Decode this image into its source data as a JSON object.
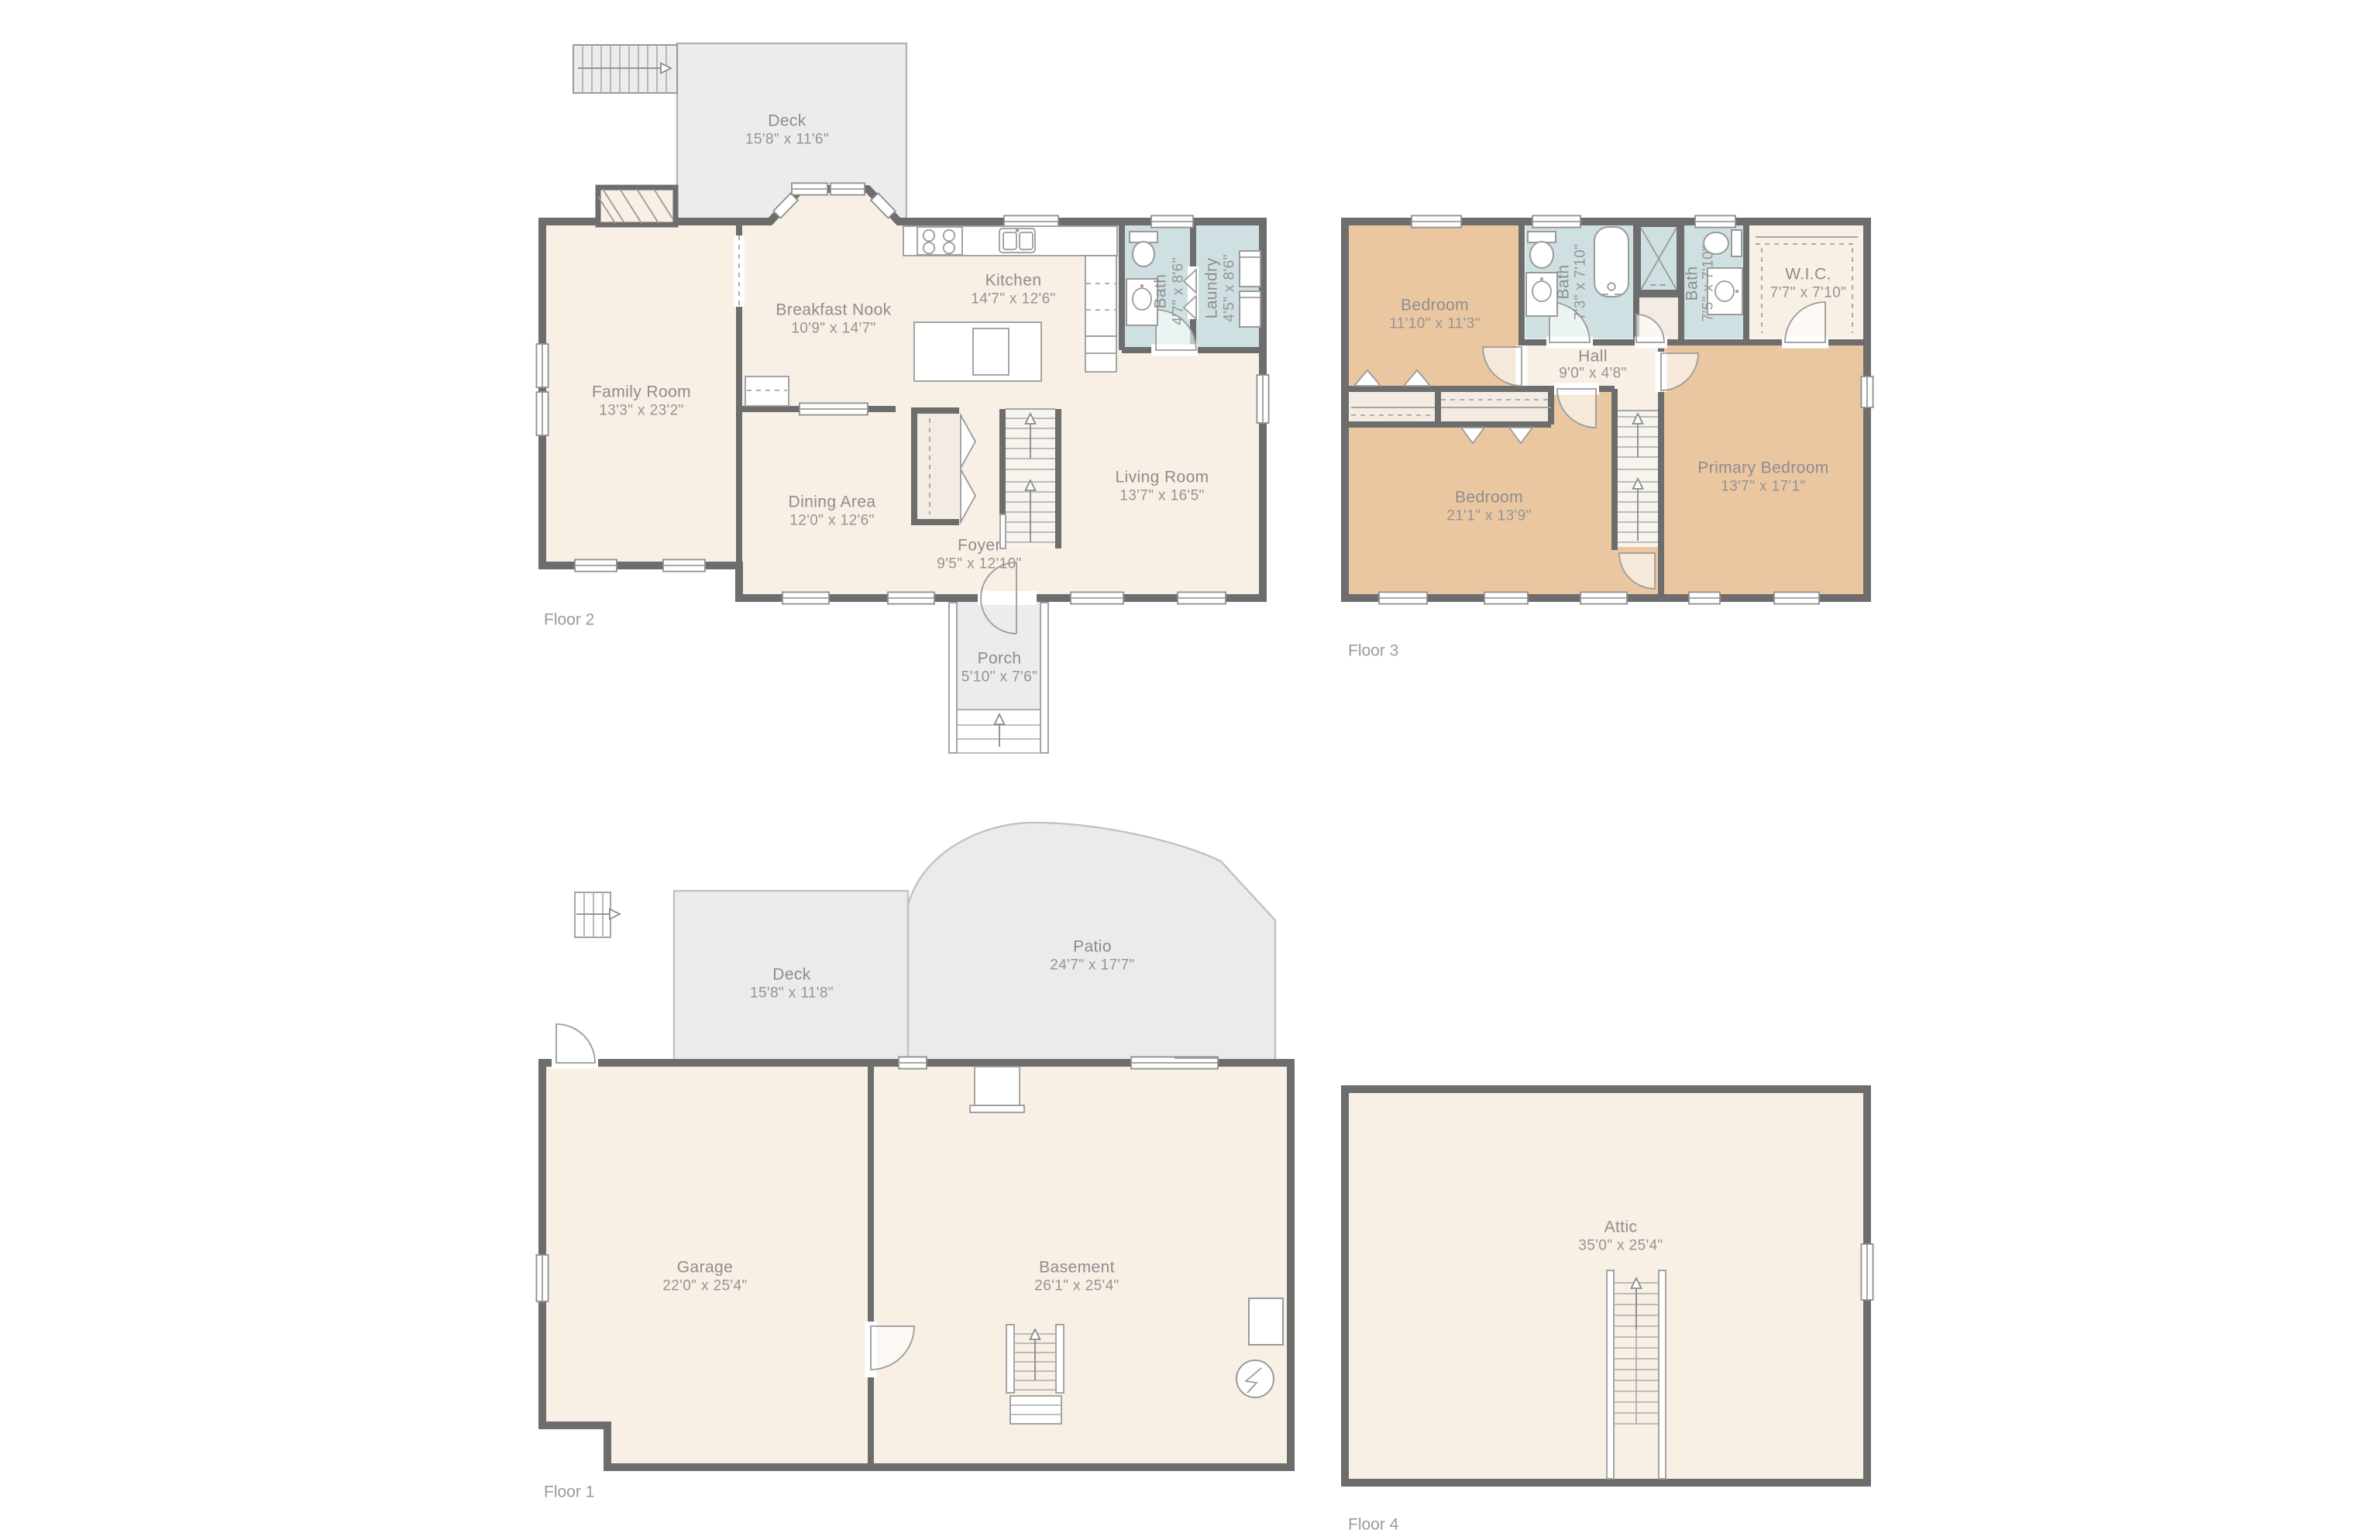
{
  "colors": {
    "wall": "#6d6d6d",
    "room_cream": "#f8efe5",
    "bedroom_orange": "#ebc7a1",
    "wet_teal": "#cfe0e2",
    "outdoor_gray": "#ececec",
    "label_gray": "#8d8d8d"
  },
  "floors": {
    "f2": {
      "label": "Floor 2",
      "rooms": {
        "deck": {
          "name": "Deck",
          "dims": "15'8\" x 11'6\""
        },
        "kitchen": {
          "name": "Kitchen",
          "dims": "14'7\" x 12'6\""
        },
        "breakfast": {
          "name": "Breakfast Nook",
          "dims": "10'9\" x 14'7\""
        },
        "family": {
          "name": "Family Room",
          "dims": "13'3\" x 23'2\""
        },
        "dining": {
          "name": "Dining Area",
          "dims": "12'0\" x 12'6\""
        },
        "living": {
          "name": "Living Room",
          "dims": "13'7\" x 16'5\""
        },
        "foyer": {
          "name": "Foyer",
          "dims": "9'5\" x 12'10\""
        },
        "porch": {
          "name": "Porch",
          "dims": "5'10\" x 7'6\""
        },
        "bath": {
          "name": "Bath",
          "dims": "4'7\" x 8'6\""
        },
        "laundry": {
          "name": "Laundry",
          "dims": "4'5\" x 8'6\""
        }
      }
    },
    "f3": {
      "label": "Floor 3",
      "rooms": {
        "bedroom1": {
          "name": "Bedroom",
          "dims": "11'10\" x 11'3\""
        },
        "bath1": {
          "name": "Bath",
          "dims": "7'3\" x 7'10\""
        },
        "bath2": {
          "name": "Bath",
          "dims": "7'5\" x 7'10\""
        },
        "wic": {
          "name": "W.I.C.",
          "dims": "7'7\" x 7'10\""
        },
        "hall": {
          "name": "Hall",
          "dims": "9'0\" x 4'8\""
        },
        "bedroom2": {
          "name": "Bedroom",
          "dims": "21'1\" x 13'9\""
        },
        "primary": {
          "name": "Primary Bedroom",
          "dims": "13'7\" x 17'1\""
        }
      }
    },
    "f1": {
      "label": "Floor 1",
      "rooms": {
        "deck": {
          "name": "Deck",
          "dims": "15'8\" x 11'8\""
        },
        "patio": {
          "name": "Patio",
          "dims": "24'7\" x 17'7\""
        },
        "garage": {
          "name": "Garage",
          "dims": "22'0\" x 25'4\""
        },
        "basement": {
          "name": "Basement",
          "dims": "26'1\" x 25'4\""
        }
      }
    },
    "f4": {
      "label": "Floor 4",
      "rooms": {
        "attic": {
          "name": "Attic",
          "dims": "35'0\" x 25'4\""
        }
      }
    }
  }
}
